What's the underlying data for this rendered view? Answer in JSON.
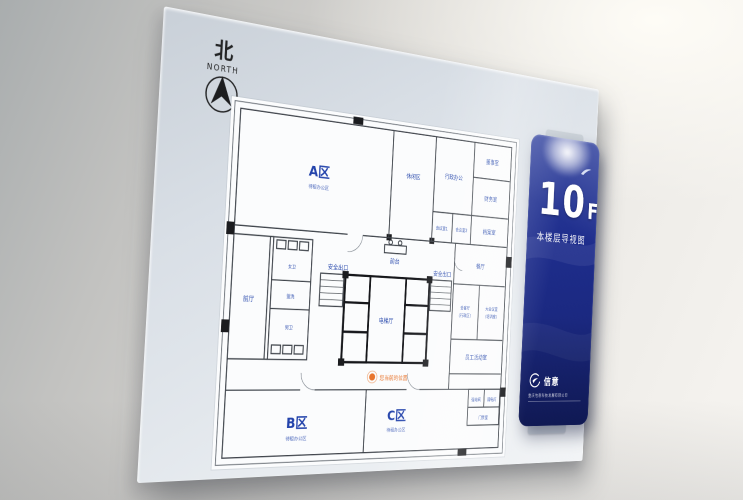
{
  "compass": {
    "north_char": "北",
    "north_label": "NORTH"
  },
  "banner": {
    "floor_number": "10",
    "floor_letter": "F",
    "title": "本楼层导视图",
    "brand": "信意",
    "company": "重庆信意科技发展有限公司"
  },
  "plan": {
    "zone_a": "A区",
    "zone_a_sub": "待租办公区",
    "zone_b": "B区",
    "zone_b_sub": "待租办公区",
    "zone_c": "C区",
    "zone_c_sub": "待租办公区",
    "rooms": {
      "leisure": "休闲区",
      "admin_office": "行政办公",
      "director": "董事室",
      "finance": "财务室",
      "archive": "档案室",
      "meeting1": "会议室1",
      "meeting2": "会议室2",
      "reception": "前台",
      "exit_left": "安全出口",
      "exit_right": "安全出口",
      "elevator_hall": "电梯厅",
      "womens": "女卫",
      "washroom": "盥洗",
      "mens": "男卫",
      "lobby": "前厅",
      "dining": "餐厅",
      "guest1": "会客厅",
      "guest2": "(行政区)",
      "training1": "大会议室",
      "training2": "(培训室)",
      "activity": "员工活动室",
      "power_strong": "强电间",
      "power_weak": "弱电间",
      "access": "门禁室"
    },
    "you_are_here": "您当前的位置"
  },
  "colors": {
    "banner_blue": "#1e2d8c",
    "label_blue": "#2b4bad",
    "location_orange": "#e8742c"
  }
}
